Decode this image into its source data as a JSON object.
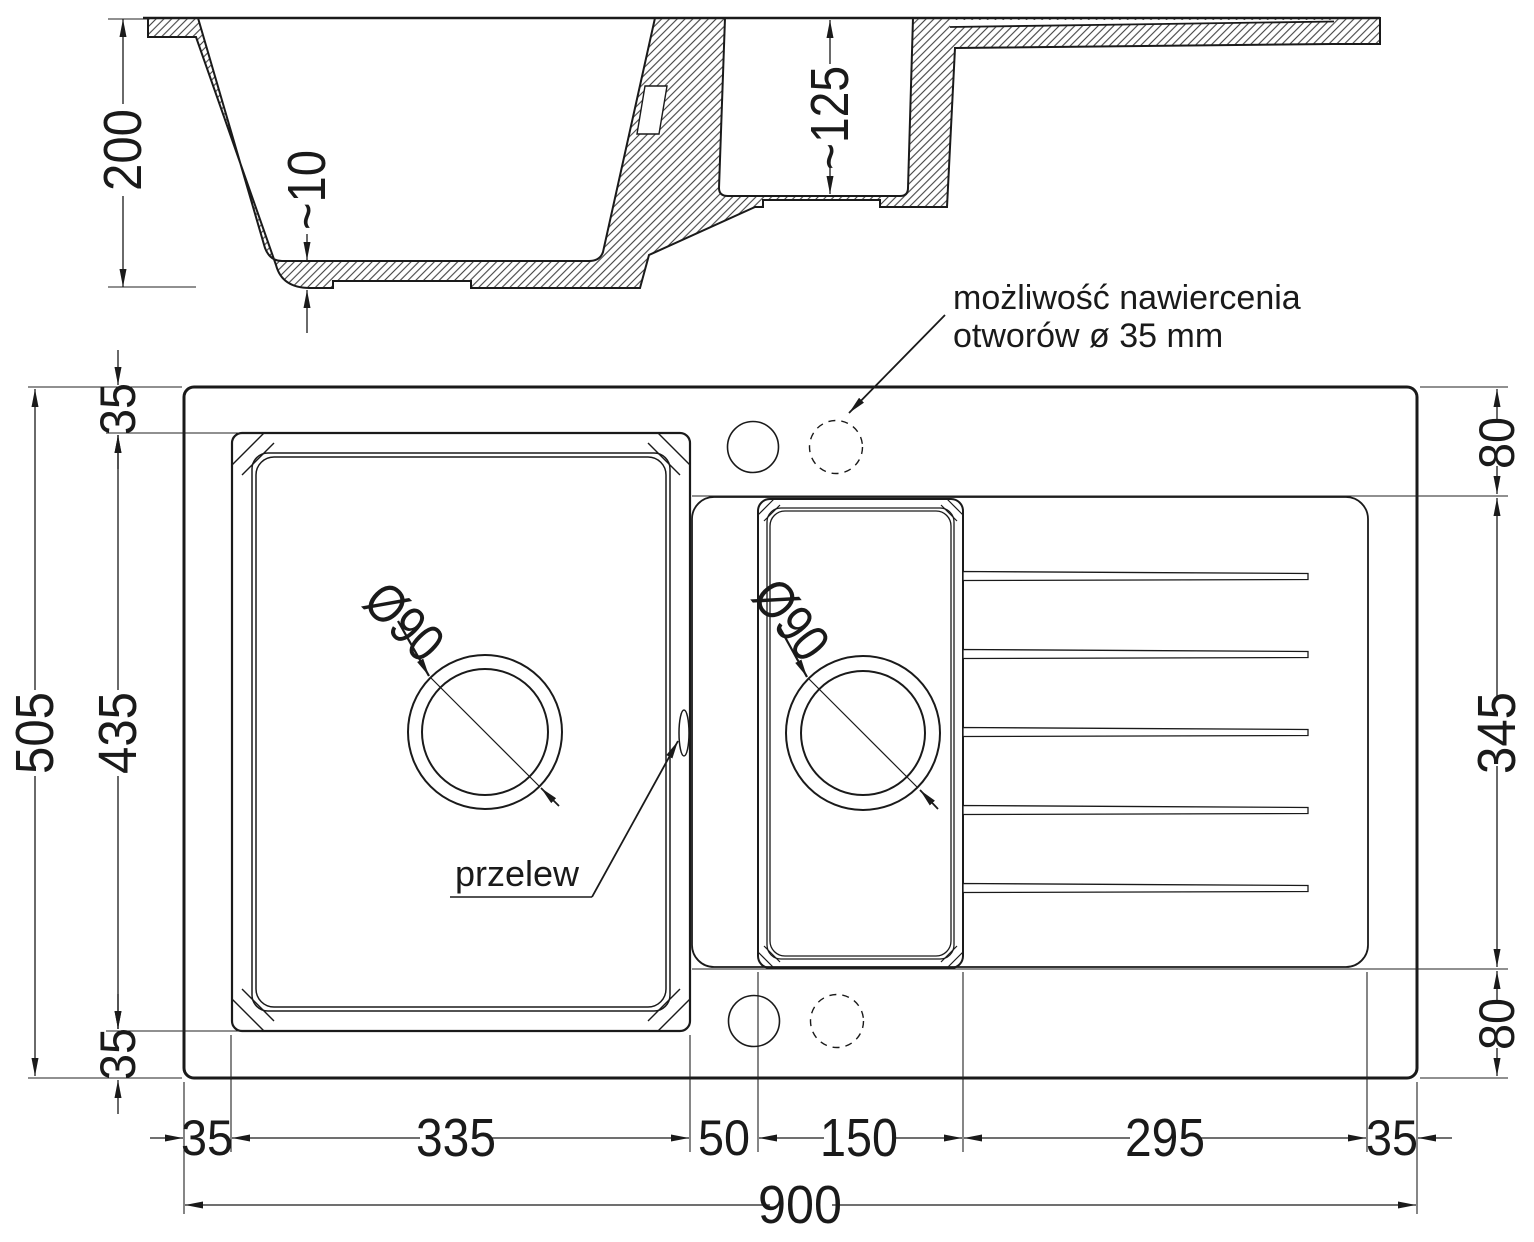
{
  "colors": {
    "ink": "#1a1a1a",
    "background": "#ffffff"
  },
  "section": {
    "depth": "200",
    "base_thickness": "~10",
    "small_bowl_depth": "~125"
  },
  "plan": {
    "note_line1": "możliwość nawiercenia",
    "note_line2": "otworów ø 35 mm",
    "overflow": "przelew",
    "main_drain": "Ø90",
    "small_drain": "Ø90",
    "left": {
      "total": "505",
      "bowl": "435",
      "top_inset": "35",
      "bottom_inset": "35"
    },
    "right": {
      "top": "80",
      "middle": "345",
      "bottom": "80"
    },
    "bottom": {
      "segments": [
        "35",
        "335",
        "50",
        "150",
        "295",
        "35"
      ],
      "total": "900"
    }
  }
}
